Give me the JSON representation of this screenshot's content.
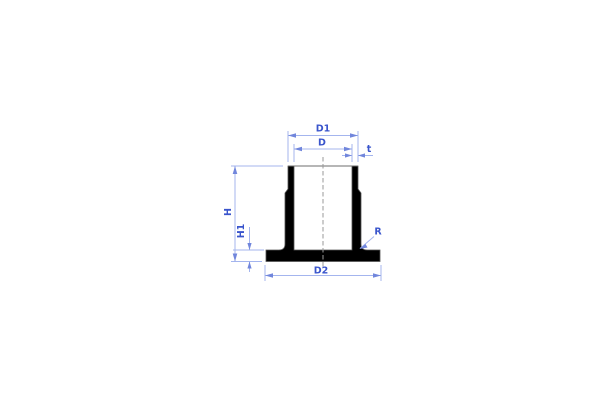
{
  "drawing": {
    "type": "technical-cross-section",
    "labels": {
      "d1": "D1",
      "d": "D",
      "t": "t",
      "h": "H",
      "h1": "H1",
      "d2": "D2",
      "r": "R"
    },
    "colors": {
      "background": "#ffffff",
      "part_fill": "#000000",
      "part_outline": "#555555",
      "top_edge": "#6e6e6e",
      "centerline": "#9a9a9a",
      "dimension_line": "#a4b5ee",
      "arrow": "#7186dc",
      "dimension_label": "#3a55cc"
    }
  }
}
